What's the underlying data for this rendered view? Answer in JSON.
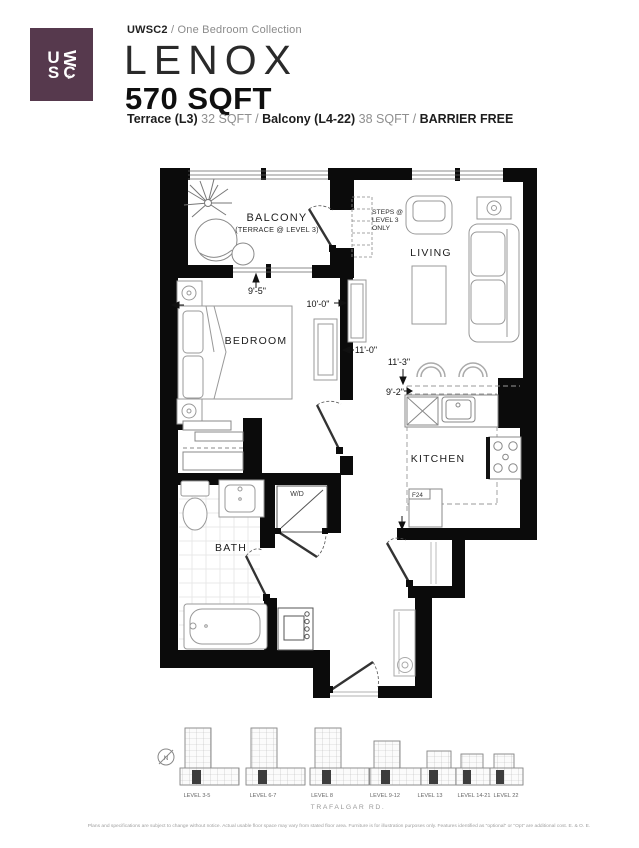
{
  "header": {
    "logo": {
      "u": "U",
      "w": "W",
      "s": "S",
      "c": "C",
      "two": "2"
    },
    "series": "UWSC2",
    "slash": "/",
    "collection": "One Bedroom Collection",
    "plan_name": "LENOX",
    "plan_size": "570 SQFT",
    "sub": {
      "terrace_label": "Terrace (L3)",
      "terrace_value": "32 SQFT",
      "slash1": "/",
      "balcony_label": "Balcony (L4-22)",
      "balcony_value": "38 SQFT",
      "slash2": "/",
      "barrier_free": "BARRIER FREE"
    }
  },
  "plan": {
    "rooms": {
      "balcony": "BALCONY",
      "balcony_note": "(TERRACE @ LEVEL 3)",
      "living": "LIVING",
      "bedroom": "BEDROOM",
      "kitchen": "KITCHEN",
      "bath": "BATH",
      "wd": "W/D",
      "fridge": "F24"
    },
    "steps_note": {
      "line1": "STEPS @",
      "line2": "LEVEL 3",
      "line3": "ONLY"
    },
    "dimensions": {
      "dim_balcony": "9'-5\"",
      "dim_bedroom": "10'-0\"",
      "dim_bedroom_len": "11'-0\"",
      "dim_living": "11'-3\"",
      "dim_kitchen": "9'-2\""
    }
  },
  "keyplan": {
    "compass": "N",
    "levels": [
      {
        "label": "LEVEL 3-5"
      },
      {
        "label": "LEVEL 6-7"
      },
      {
        "label": "LEVEL 8"
      },
      {
        "label": "LEVEL 9-12"
      },
      {
        "label": "LEVEL 13"
      },
      {
        "label": "LEVEL 14-21"
      },
      {
        "label": "LEVEL 22"
      }
    ],
    "street": "TRAFALGAR RD."
  },
  "footer": {
    "disclaimer": "Plans and specifications are subject to change without notice. Actual usable floor space may vary from stated floor area. Furniture is for illustration purposes only. Features identified as \"optional\" or \"Opt\" are additional cost. E. & O. E."
  },
  "colors": {
    "brand_plum": "#56394d",
    "wall_black": "#0b0b0b"
  }
}
